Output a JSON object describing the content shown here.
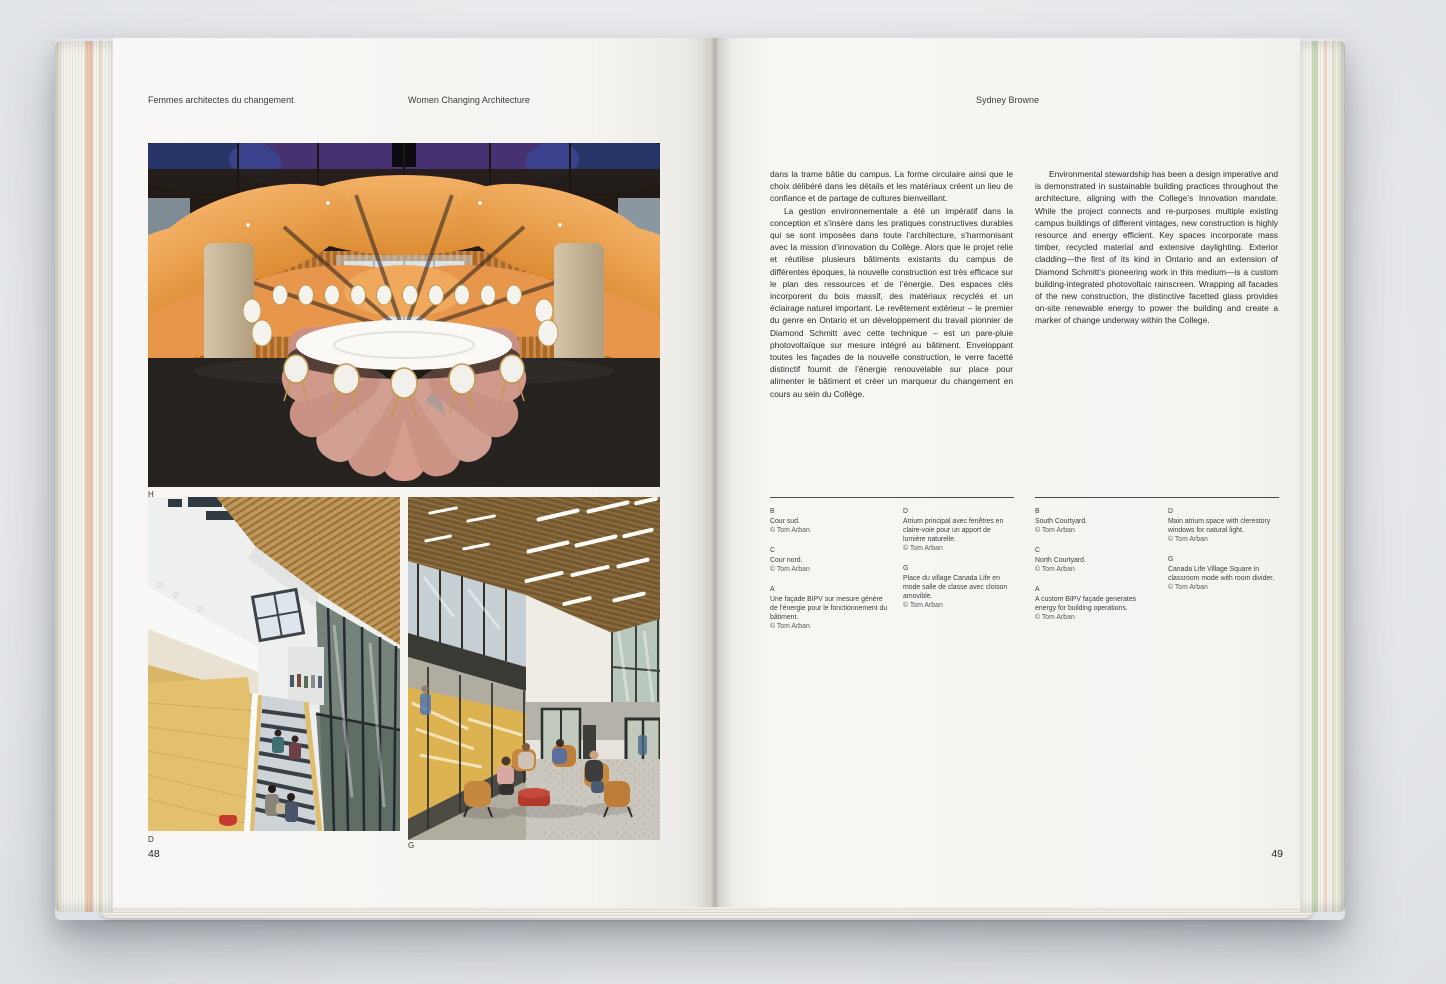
{
  "palette": {
    "backdrop": "#e7e9ec",
    "paper": "#f5f4f1",
    "petal_orange": "#e8974a",
    "floor_salmon": "#d49a8b",
    "wood_tan": "#c29a5e",
    "accent_red": "#b23a2c"
  },
  "left_page": {
    "running_head_fr": "Femmes architectes du changement",
    "running_head_en": "Women Changing Architecture",
    "photo_labels": {
      "top": "H",
      "bottom_left": "D",
      "bottom_right": "G"
    },
    "page_number": "48"
  },
  "right_page": {
    "running_head": "Sydney Browne",
    "page_number": "49",
    "columns": {
      "fr": [
        "dans la trame bâtie du campus. La forme circulaire ainsi que le choix délibéré dans les détails et les matériaux créent un lieu de confiance et de partage de cultures bienveillant.",
        "La gestion environnementale a été un impératif dans la conception et s’insère dans les pratiques constructives durables qui se sont imposées dans toute l’architecture, s’harmonisant avec la mission d’innovation du Collège. Alors que le projet relie et réutilise plusieurs bâtiments existants du campus de différentes époques, la nouvelle construction est très efficace sur le plan des ressources et de l’énergie. Des espaces clés incorporent du bois massif, des matériaux recyclés et un éclairage naturel important. Le revêtement extérieur – le premier du genre en Ontario et un développement du travail pionnier de Diamond Schmitt avec cette technique – est un pare-pluie photovoltaïque sur mesure intégré au bâtiment. Enveloppant toutes les façades de la nouvelle construction, le verre facetté distinctif fournit de l’énergie renouvelable sur place pour alimenter le bâtiment et créer un marqueur du changement en cours au sein du Collège."
      ],
      "en": [
        "Environmental stewardship has been a design imperative and is demonstrated in sustainable building practices throughout the architecture, aligning with the College’s Innovation mandate. While the project connects and re-purposes multiple existing campus buildings of different vintages, new construction is highly resource and energy efficient. Key spaces incorporate mass timber, recycled material and extensive daylighting. Exterior cladding—the first of its kind in Ontario and an extension of Diamond Schmitt’s pioneering work in this medium—is a custom building-integrated photovoltaic rainscreen. Wrapping all facades of the new construction, the distinctive facetted glass provides on-site renewable energy to power the building and create a marker of change underway within the College."
      ]
    },
    "captions_fr": {
      "col1": [
        {
          "letter": "B",
          "text": "Cour sud.",
          "credit": "© Tom Arban"
        },
        {
          "letter": "C",
          "text": "Cour nord.",
          "credit": "© Tom Arban"
        },
        {
          "letter": "A",
          "text": "Une façade BIPV sur mesure génère de l’énergie pour le fonctionnement du bâtiment.",
          "credit": "© Tom Arban"
        }
      ],
      "col2": [
        {
          "letter": "D",
          "text": "Atrium principal avec fenêtres en claire-voie pour un apport de lumière naturelle.",
          "credit": "© Tom Arban"
        },
        {
          "letter": "G",
          "text": "Place du village Canada Life en mode salle de classe avec cloison amovible.",
          "credit": "© Tom Arban"
        }
      ]
    },
    "captions_en": {
      "col1": [
        {
          "letter": "B",
          "text": "South Courtyard.",
          "credit": "© Tom Arban"
        },
        {
          "letter": "C",
          "text": "North Courtyard.",
          "credit": "© Tom Arban"
        },
        {
          "letter": "A",
          "text": "A custom BIPV façade generates energy for building operations.",
          "credit": "© Tom Arban"
        }
      ],
      "col2": [
        {
          "letter": "D",
          "text": "Main atrium space with clerestory windows for natural light.",
          "credit": "© Tom Arban"
        },
        {
          "letter": "G",
          "text": "Canada Life Village Square in classroom mode with room divider.",
          "credit": "© Tom Arban"
        }
      ]
    }
  }
}
